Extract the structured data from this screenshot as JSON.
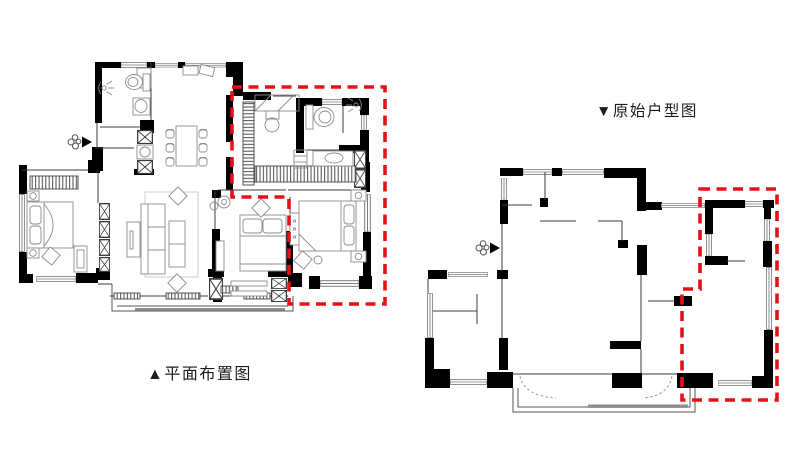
{
  "page": {
    "background": "#ffffff"
  },
  "plans": [
    {
      "id": "furniture-layout-plan",
      "caption": "▲平面布置图"
    },
    {
      "id": "original-floor-plan",
      "caption": "▼原始户型图"
    }
  ],
  "colors": {
    "wall": "#000000",
    "thin": "#3d3d3d",
    "furniture": "#8c8c8c",
    "window": "#7a7a7a",
    "highlight": "#e81016",
    "text": "#1c1c1c",
    "background": "#ffffff"
  }
}
